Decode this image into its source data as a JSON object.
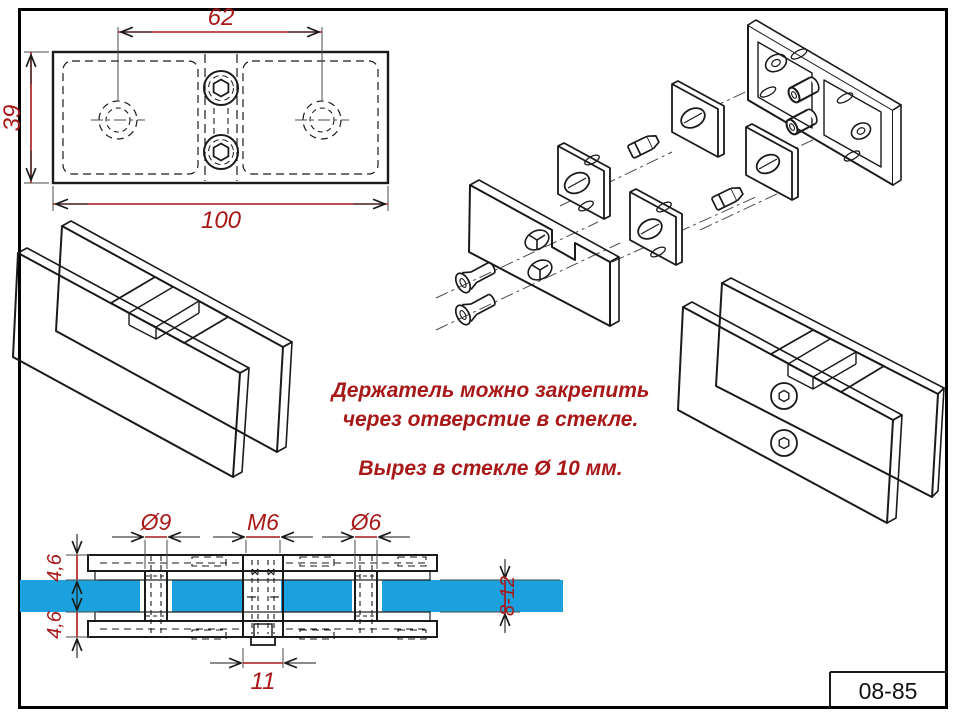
{
  "colors": {
    "dimension_red": "#A81818",
    "glass_blue": "#1BA2DE",
    "line_black": "#1A1A1A",
    "background": "#FFFFFF"
  },
  "note": {
    "line1": "Держатель можно закрепить",
    "line2": "через отверстие в стекле.",
    "line3": "Вырез в стекле Ø 10 мм."
  },
  "top_view": {
    "hole_spacing": "62",
    "height": "39",
    "width": "100"
  },
  "section_view": {
    "hole_left": "Ø9",
    "thread": "M6",
    "hole_right": "Ø6",
    "plate_top": "4,6",
    "plate_bottom": "4,6",
    "glass_thickness": "8-12",
    "boss_width": "11"
  },
  "title_block": {
    "part_number": "08-85"
  }
}
